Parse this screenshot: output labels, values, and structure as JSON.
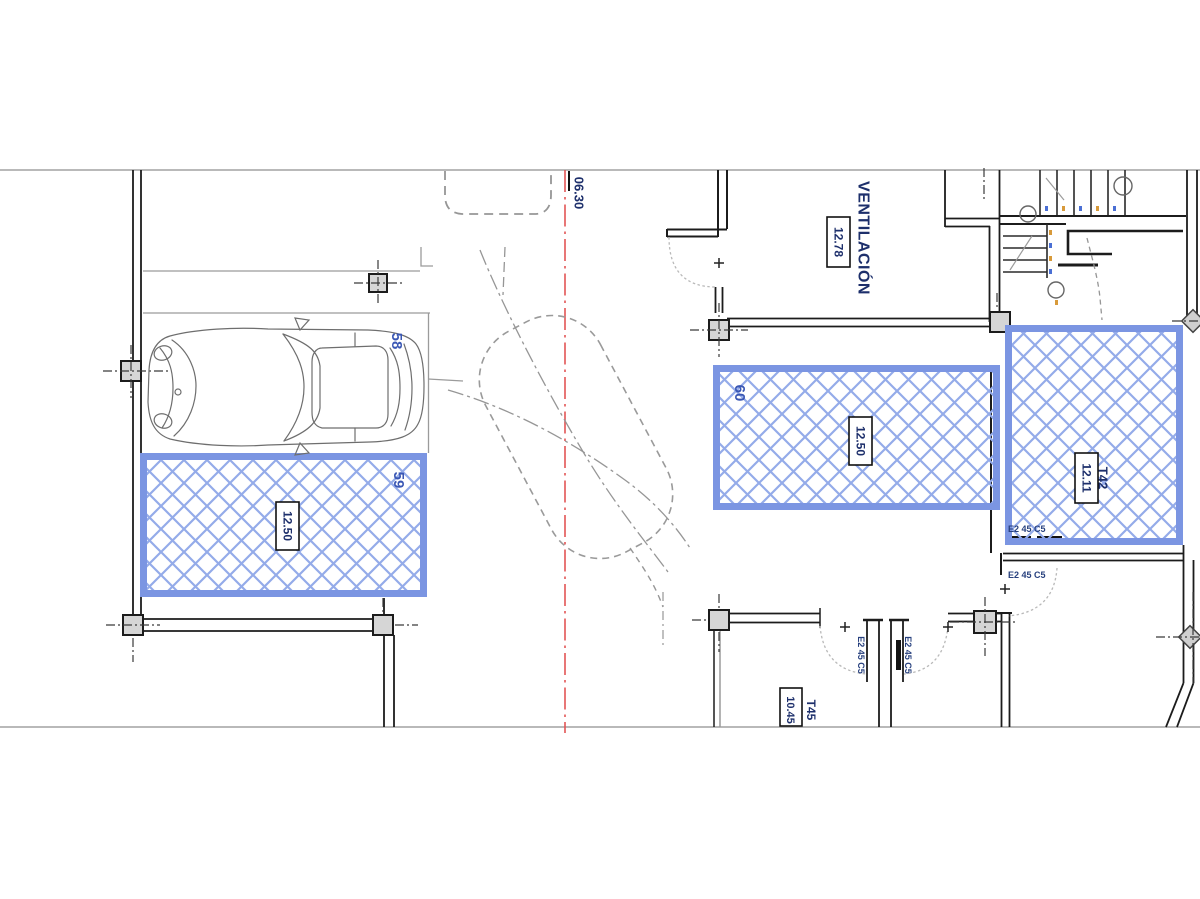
{
  "plan": {
    "ramp_width_label": "06.30",
    "ventilation": {
      "name": "VENTILACIÓN",
      "area": "12.78"
    },
    "spaces": {
      "s58": {
        "number": "58"
      },
      "s59": {
        "number": "59",
        "area": "12.50"
      },
      "s60": {
        "number": "60",
        "area": "12.50"
      }
    },
    "trasteros": {
      "t42": {
        "code": "T42",
        "area": "12.11"
      },
      "t45": {
        "code": "T45",
        "area": "10.45"
      }
    },
    "doors": {
      "t42_top": "E2 45 C5",
      "t42_bottom": "E2 45 C5",
      "lobby_left": "E2 45 C5",
      "lobby_right": "E2 45 C5"
    }
  },
  "colors": {
    "highlight_border": "#7b95e2",
    "highlight_hatch": "#94abe9",
    "wall": "#1c1c1c",
    "centerline_red": "#e25555",
    "label_navy": "#1d2f6b",
    "space_number_blue": "#3a57b4",
    "gray_line": "#9b9b9b"
  }
}
